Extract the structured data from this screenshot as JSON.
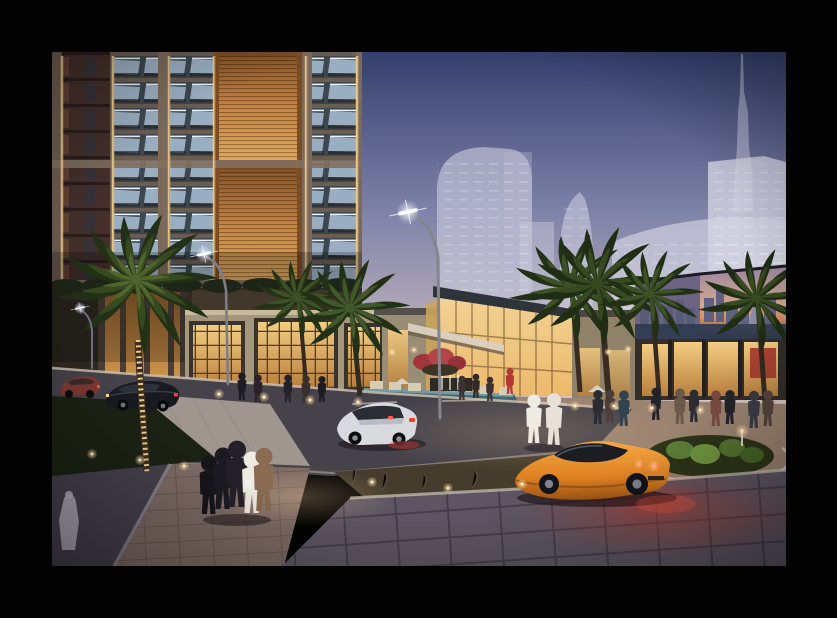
{
  "image": {
    "kind": "architectural rendering",
    "time_of_day": "dusk",
    "frame_color": "#020202",
    "scene_elements": [
      "high-rise residential tower with glass balconies and backlit bronze louver panels",
      "hazy downtown skyline with supertall spire in background",
      "retail podium with warmly lit storefront windows",
      "glass entrance pavilion with angled dark canopy roof",
      "corner retail block wrapped with a city-skyline billboard",
      "reflecting pool with fountain, seat blocks and red flowering shrubs",
      "date palms, one trunk wrapped in string lights",
      "curved street lamps with glowing LED heads",
      "asphalt street with pale pedestrian crossing and lane dashes",
      "dark hedge and dry-scrub medians with bollard uplights",
      "stone-paved driveway plaza washed in red taillight glow",
      "orange sports car with lit taillights",
      "white hatchback driving on the street",
      "dark sedan and small red car parked near the podium",
      "group of pedestrians crossing, two figures in white kanduras, shoppers at storefronts",
      "pale statue-like figure on the lower sidewalk"
    ]
  },
  "palette": {
    "sky_top": "#353f6d",
    "sky_mid": "#8083a8",
    "sky_horizon": "#d6c6c9",
    "haze_tower": "#cfcfe2",
    "orange_panel": "#c98440",
    "pavilion_glass": "#ecb96a",
    "billboard_sky": "#9b85a0",
    "palm_mid": "#36491f",
    "trunk_lights": "#f6d38b",
    "hedge": "#1b2214",
    "road": "#45424a",
    "plaza_warm": "#9a8270",
    "paver_cool": "#5d5662",
    "red_glow": "#c03b31",
    "lambo": "#e08224",
    "lambo_hi": "#f5a843",
    "white_car": "#d9dade",
    "sedan": "#181a1f",
    "robe": "#eeebe2"
  }
}
